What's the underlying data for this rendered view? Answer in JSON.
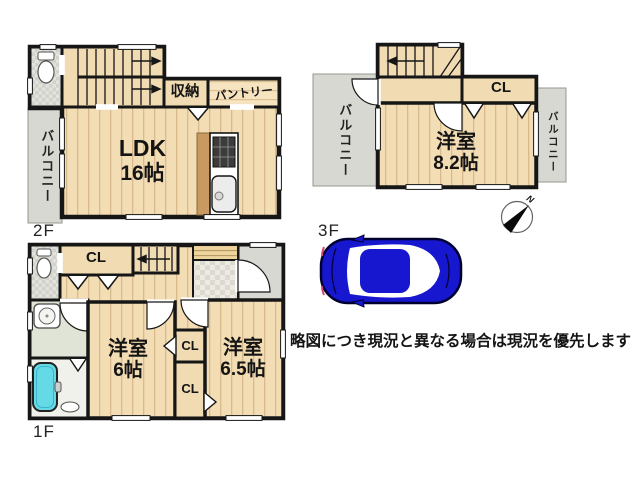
{
  "disclaimer": "略図につき現況と異なる場合は現況を優先します",
  "compass": {
    "north": "N"
  },
  "floors": {
    "f2": {
      "label": "2F",
      "ldk_name": "LDK",
      "ldk_size": "16帖",
      "storage": "収納",
      "pantry": "パントリー",
      "balcony": "バルコニー"
    },
    "f3": {
      "label": "3F",
      "room_name": "洋室",
      "room_size": "8.2帖",
      "closet": "CL",
      "balcony_left": "バルコニー",
      "balcony_right": "バルコニー"
    },
    "f1": {
      "label": "1F",
      "hall_closet": "CL",
      "room1_name": "洋室",
      "room1_size": "6帖",
      "closet_top": "CL",
      "closet_bottom": "CL",
      "room2_name": "洋室",
      "room2_size": "6.5帖"
    }
  },
  "colors": {
    "wall": "#161616",
    "wood_floor": "#f3ddb4",
    "wood_line": "#d9ba8c",
    "balcony_gray": "#d8d8d2",
    "bathtub_cyan": "#66d9e6",
    "car_blue": "#1717cf",
    "tile_gray": "#e3e3dd"
  }
}
